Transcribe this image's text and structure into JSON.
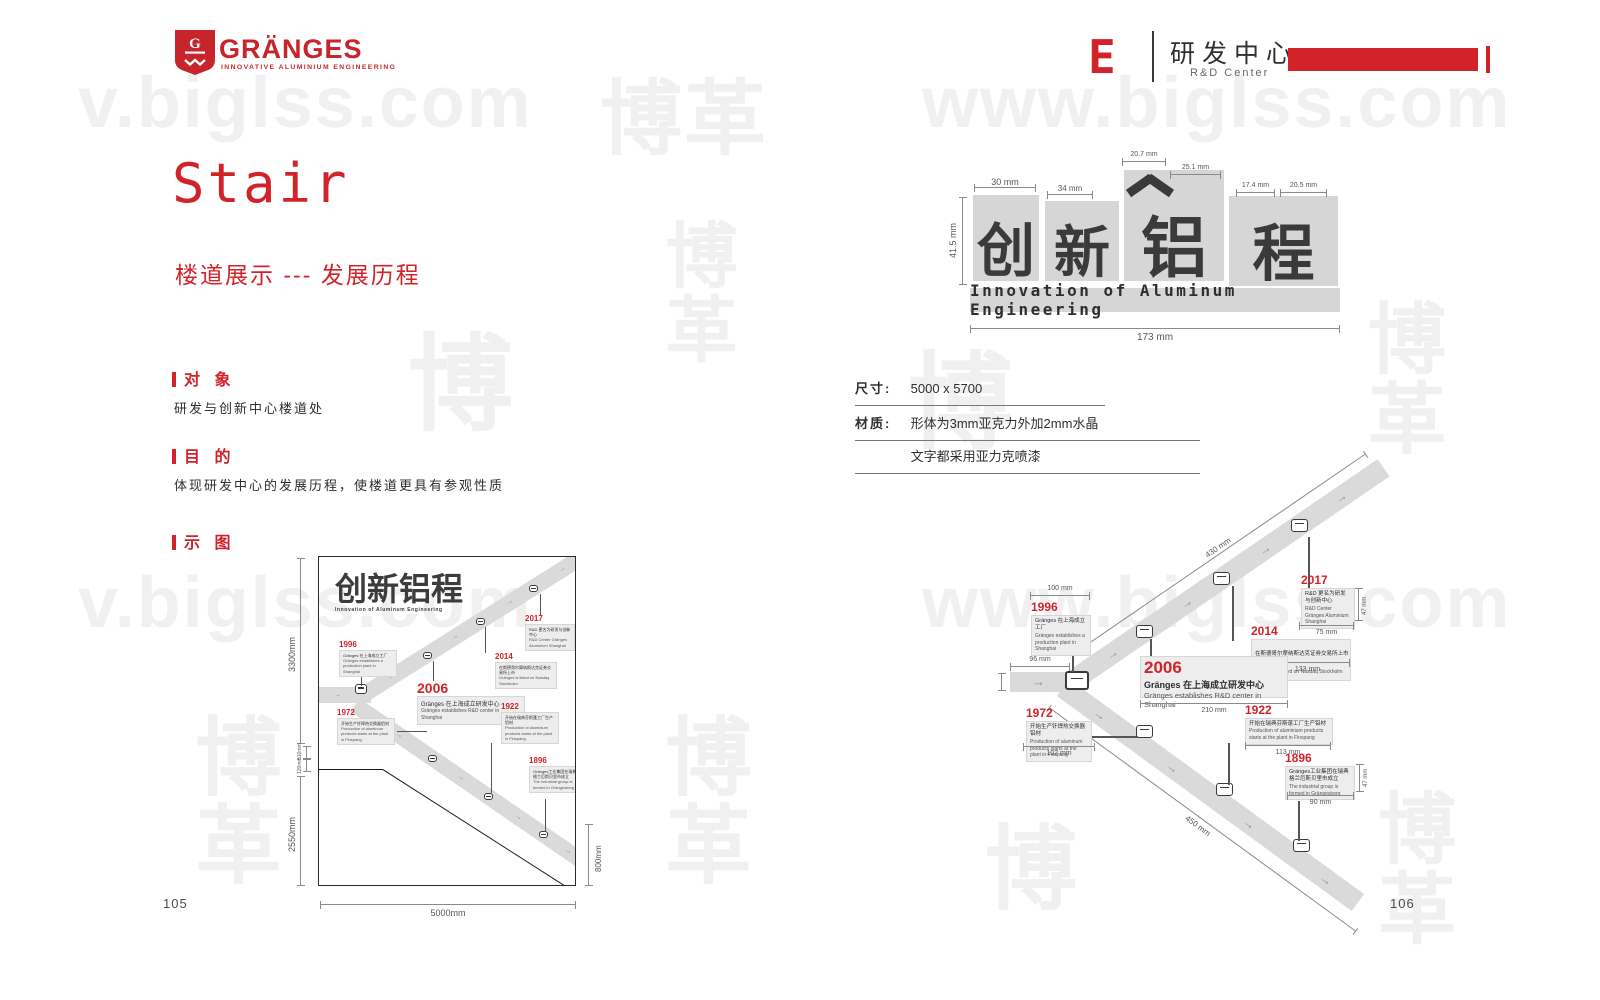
{
  "accent": "#d2232a",
  "brand_red": "#c8242c",
  "header": {
    "brand": {
      "name": "GRÄNGES",
      "tagline": "INNOVATIVE ALUMINIUM ENGINEERING",
      "shield_letter": "G"
    },
    "section": {
      "letter": "E",
      "title_zh": "研发中心",
      "title_en": "R&D Center"
    }
  },
  "watermark": {
    "text_left": "v.biglss.com",
    "text_right": "www.biglss.com",
    "glyphs": "博革"
  },
  "left_page": {
    "page_number": "105",
    "title": "Stair",
    "subtitle": "楼道展示 --- 发展历程",
    "sections": [
      {
        "heading": "对 象",
        "body": "研发与创新中心楼道处"
      },
      {
        "heading": "目 的",
        "body": "体现研发中心的发展历程，使楼道更具有参观性质"
      },
      {
        "heading": "示 图",
        "body": ""
      }
    ],
    "diagram_dims": {
      "height_upper": "3300mm",
      "height_lower": "2550mm",
      "small_upper": "510mm",
      "small_lower": "120mm",
      "width": "5000mm",
      "right": "800mm"
    }
  },
  "right_page": {
    "page_number": "106",
    "sign": {
      "chars": {
        "c1": "创",
        "c2": "新",
        "c3": "铝",
        "c4": "程"
      },
      "english": "Innovation of Aluminum Engineering",
      "dims": {
        "total_width": "173 mm",
        "height": "41.5 mm",
        "d30": "30 mm",
        "d34": "34 mm",
        "d207": "20.7 mm",
        "d251": "25.1 mm",
        "d174": "17.4 mm",
        "d205": "20.5 mm"
      }
    },
    "specs": [
      {
        "label": "尺寸:",
        "value": "5000 x 5700"
      },
      {
        "label": "材质:",
        "value": "形体为3mm亚克力外加2mm水晶"
      },
      {
        "label": "",
        "value": "文字都采用亚力克喷漆"
      }
    ],
    "band_dims": {
      "upper": "430 mm",
      "lower": "450 mm",
      "entry": "96 mm"
    }
  },
  "diagram_logo": {
    "zh": "创新铝程",
    "en": "Innovation of Aluminum Engineering"
  },
  "timeline": [
    {
      "year": "1996",
      "zh": "Gränges 在上海成立工厂",
      "en": "Gränges establishes a production plant in Shanghai",
      "dim_w": "100 mm"
    },
    {
      "year": "2017",
      "zh": "R&D 更名为研发与创新中心",
      "en": "R&D Center Gränges Aluminium Shanghai",
      "dim_w": "75 mm",
      "dim_h": "47 mm"
    },
    {
      "year": "2014",
      "zh": "在斯德哥尔摩纳斯达克证券交易所上市",
      "en": "Gränges is listed on Nasdaq Stockholm",
      "dim_w": "133 mm"
    },
    {
      "year": "2006",
      "zh": "Gränges 在上海成立研发中心",
      "en": "Gränges establishes R&D center in Shanghai",
      "dim_w": "210 mm"
    },
    {
      "year": "1972",
      "zh": "开始生产钎焊热交换器铝材",
      "en": "Production of aluminum products starts at the plant in Finspang",
      "dim_w": "102 mm"
    },
    {
      "year": "1922",
      "zh": "开始在瑞典芬斯蓬工厂生产铝材",
      "en": "Production of aluminium products starts at the plant in Finspang",
      "dim_w": "113 mm"
    },
    {
      "year": "1896",
      "zh": "Gränges工业集团在瑞典格兰厄斯贝里市成立",
      "en": "The industrial group is formed in Grängesberg",
      "dim_w": "90 mm",
      "dim_h": "47 mm"
    }
  ]
}
